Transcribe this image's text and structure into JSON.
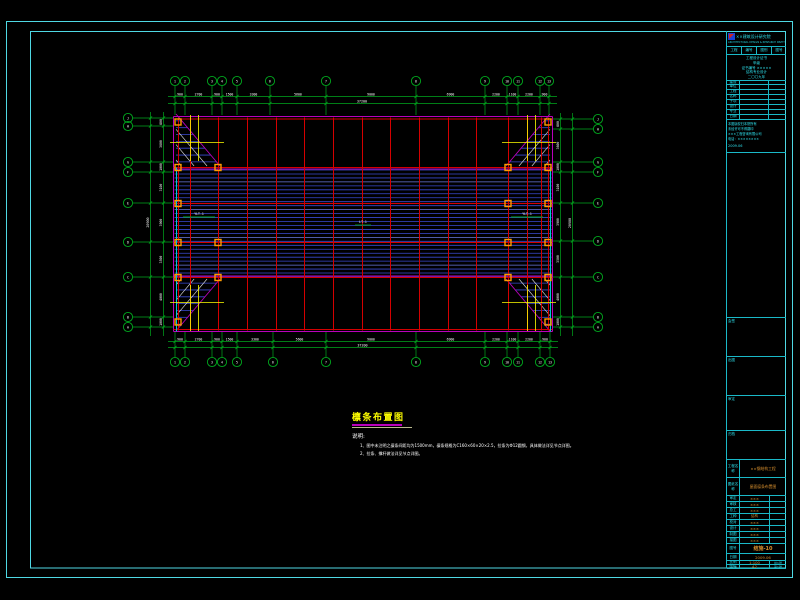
{
  "colors": {
    "background": "#000000",
    "frame": "#4fd8e4",
    "grid_green": "#00a81e",
    "axis_red": "#d40000",
    "purlin_blue": "#3a4ad0",
    "purlin_blue_light": "#6b7ae0",
    "magenta": "#bb00bb",
    "cyan_bright": "#00c8d7",
    "marker_orange": "#ff9c00",
    "brace_white": "#e0e0e0",
    "tie_yellow": "#ffff00",
    "dim_text": "#ffffff",
    "note_yellow": "#ffff00",
    "tb_cyan": "#2ee0ec",
    "tb_orange": "#d8902f"
  },
  "plan": {
    "left": 173.5,
    "right": 552.5,
    "top": 116.5,
    "bottom": 331.5,
    "band_top": 170,
    "band_bottom": 277,
    "purlin_count": 28,
    "red_h": [
      119,
      167.5,
      203.5,
      242.5,
      277.5,
      329.5
    ],
    "red_v": [
      178,
      190,
      218,
      247,
      276,
      304,
      333,
      362,
      390,
      419,
      448,
      476,
      508,
      527,
      541,
      548
    ],
    "magenta_h": [
      116.5,
      169,
      276,
      331.5
    ],
    "magenta_v": [
      173.5,
      552.5
    ],
    "cyan_v": [
      176.5,
      550.5
    ],
    "corners": [
      [
        176,
        114,
        220,
        166
      ],
      [
        550,
        114,
        506,
        166
      ],
      [
        176,
        331,
        220,
        279
      ],
      [
        550,
        331,
        506,
        279
      ]
    ],
    "ties": [
      {
        "vx": [
          190.5,
          198.5
        ],
        "vy": [
          115,
          161
        ],
        "h": {
          "y": 142.5,
          "x1": 170,
          "x2": 224
        }
      },
      {
        "vx": [
          527.5,
          535.5
        ],
        "vy": [
          115,
          161
        ],
        "h": {
          "y": 142.5,
          "x1": 502,
          "x2": 556
        }
      },
      {
        "vx": [
          190.5,
          198.5
        ],
        "vy": [
          285,
          331
        ],
        "h": {
          "y": 302.5,
          "x1": 170,
          "x2": 224
        }
      },
      {
        "vx": [
          527.5,
          535.5
        ],
        "vy": [
          285,
          331
        ],
        "h": {
          "y": 302.5,
          "x1": 502,
          "x2": 556
        }
      }
    ],
    "markers": {
      "rows": [
        {
          "y": 122,
          "xs": [
            178,
            548
          ]
        },
        {
          "y": 167.5,
          "xs": [
            178,
            218,
            508,
            548
          ]
        },
        {
          "y": 203.5,
          "xs": [
            178,
            508,
            548
          ]
        },
        {
          "y": 242.5,
          "xs": [
            178,
            218,
            508,
            548
          ]
        },
        {
          "y": 277.5,
          "xs": [
            178,
            218,
            508,
            548
          ]
        },
        {
          "y": 322,
          "xs": [
            178,
            548
          ]
        }
      ]
    },
    "green_dashes": [
      [
        183,
        217,
        215,
        217
      ],
      [
        511,
        217,
        543,
        217
      ],
      [
        355,
        225,
        371,
        225
      ]
    ],
    "member_labels": [
      {
        "x": 199,
        "y": 215,
        "t": "YLT-1"
      },
      {
        "x": 363,
        "y": 223,
        "t": "LT-1"
      },
      {
        "x": 527,
        "y": 215,
        "t": "YLT-1"
      }
    ]
  },
  "axes": {
    "top": {
      "bubble_y": 81,
      "stub_y1": 86,
      "stub_y2": 115,
      "dim_y1": 96.5,
      "dim_y2": 103.5,
      "xs": [
        175,
        185,
        212,
        222,
        237,
        270,
        326,
        416,
        485,
        507,
        518,
        540,
        549
      ],
      "labels": [
        "1",
        "2",
        "3",
        "4",
        "5",
        "6",
        "7",
        "8",
        "9",
        "10",
        "11",
        "12",
        "13"
      ]
    },
    "bottom": {
      "bubble_y": 362,
      "stub_y1": 357,
      "stub_y2": 332,
      "dim_y1": 341.5,
      "dim_y2": 347.5,
      "xs": [
        175,
        185,
        212,
        222,
        237,
        273,
        326,
        416,
        485,
        507,
        518,
        540,
        550
      ],
      "labels": [
        "1",
        "2",
        "3",
        "4",
        "5",
        "6",
        "7",
        "8",
        "9",
        "10",
        "11",
        "12",
        "13"
      ]
    },
    "left": {
      "bubble_x": 128,
      "stub_x1": 133,
      "stub_x2": 173,
      "dim_x1": 150.5,
      "dim_x2": 163.5,
      "ys": [
        118,
        126,
        162,
        172,
        203,
        242,
        277,
        317,
        327
      ],
      "labels": [
        "J",
        "H",
        "G",
        "F",
        "E",
        "D",
        "C",
        "B",
        "A"
      ]
    },
    "right": {
      "bubble_x": 598,
      "stub_x1": 593,
      "stub_x2": 553,
      "dim_x1": 560.5,
      "dim_x2": 572.5,
      "ys": [
        119,
        129,
        162,
        172,
        203,
        241,
        277,
        317,
        327
      ],
      "labels": [
        "J",
        "H",
        "G",
        "F",
        "E",
        "D",
        "C",
        "B",
        "A"
      ]
    }
  },
  "dims": {
    "top_segments": [
      "900",
      "2700",
      "900",
      "1500",
      "3300",
      "5600",
      "9000",
      "6900",
      "2200",
      "1100",
      "2200",
      "900"
    ],
    "side_segments": [
      "800",
      "3600",
      "1000",
      "3100",
      "3900",
      "3500",
      "4000",
      "1000"
    ],
    "total_horizontal": "37200",
    "total_vertical": "20900"
  },
  "notes": {
    "title": "檩条布置图",
    "heading": "说明:",
    "items": [
      "1、图中未注明之檩条间距均为1500mm，檩条规格为C160×60×20×2.5，拉条为Φ12圆钢，具体做法详见节点详图。",
      "2、拉条、撑杆做法详见节点详图。"
    ]
  },
  "titleblock": {
    "company": "××建筑设计研究院",
    "company_en": "ARCHITECTURAL DESIGN & RESEARCH INSTITUTE",
    "header_cells": [
      "工程",
      "编号",
      "图别",
      "图号"
    ],
    "cert_lines": [
      "工程设计证书",
      "甲级",
      "证书编号 ×××××",
      "结构专业设计",
      "二〇〇九年"
    ],
    "info_labels": [
      "建设",
      "单位",
      "工程",
      "名称",
      "子项",
      "设计",
      "专业",
      "日期"
    ],
    "notice_lines": [
      "本图版权归本院所有",
      "未经许可不得翻印",
      "×××工程咨询有限公司",
      "电话：××××××××"
    ],
    "date_line": "2009.06",
    "sections": [
      "会签",
      "出图",
      "审定",
      "归档"
    ],
    "project_row": {
      "label": "工程名称",
      "value": "××钢结构工程"
    },
    "sheet_row": {
      "label": "图纸名称",
      "value": "屋面檩条布置图"
    },
    "personnel": [
      {
        "label": "审定",
        "value": "×××"
      },
      {
        "label": "审核",
        "value": "×××"
      },
      {
        "label": "总工",
        "value": "×××"
      },
      {
        "label": "工种",
        "value": "结构"
      },
      {
        "label": "校对",
        "value": "×××"
      },
      {
        "label": "设计",
        "value": "×××"
      },
      {
        "label": "制图",
        "value": "×××"
      },
      {
        "label": "描图",
        "value": "×××"
      }
    ],
    "no_row": {
      "label": "图号",
      "value": "结施-10"
    },
    "date_row": {
      "label": "日期",
      "value": "2009.06"
    },
    "scale_row": {
      "label": "比例",
      "value": "1:100",
      "extra": "共1张"
    },
    "size_row": {
      "label": "图幅",
      "value": "A2",
      "extra": "第1张"
    }
  }
}
